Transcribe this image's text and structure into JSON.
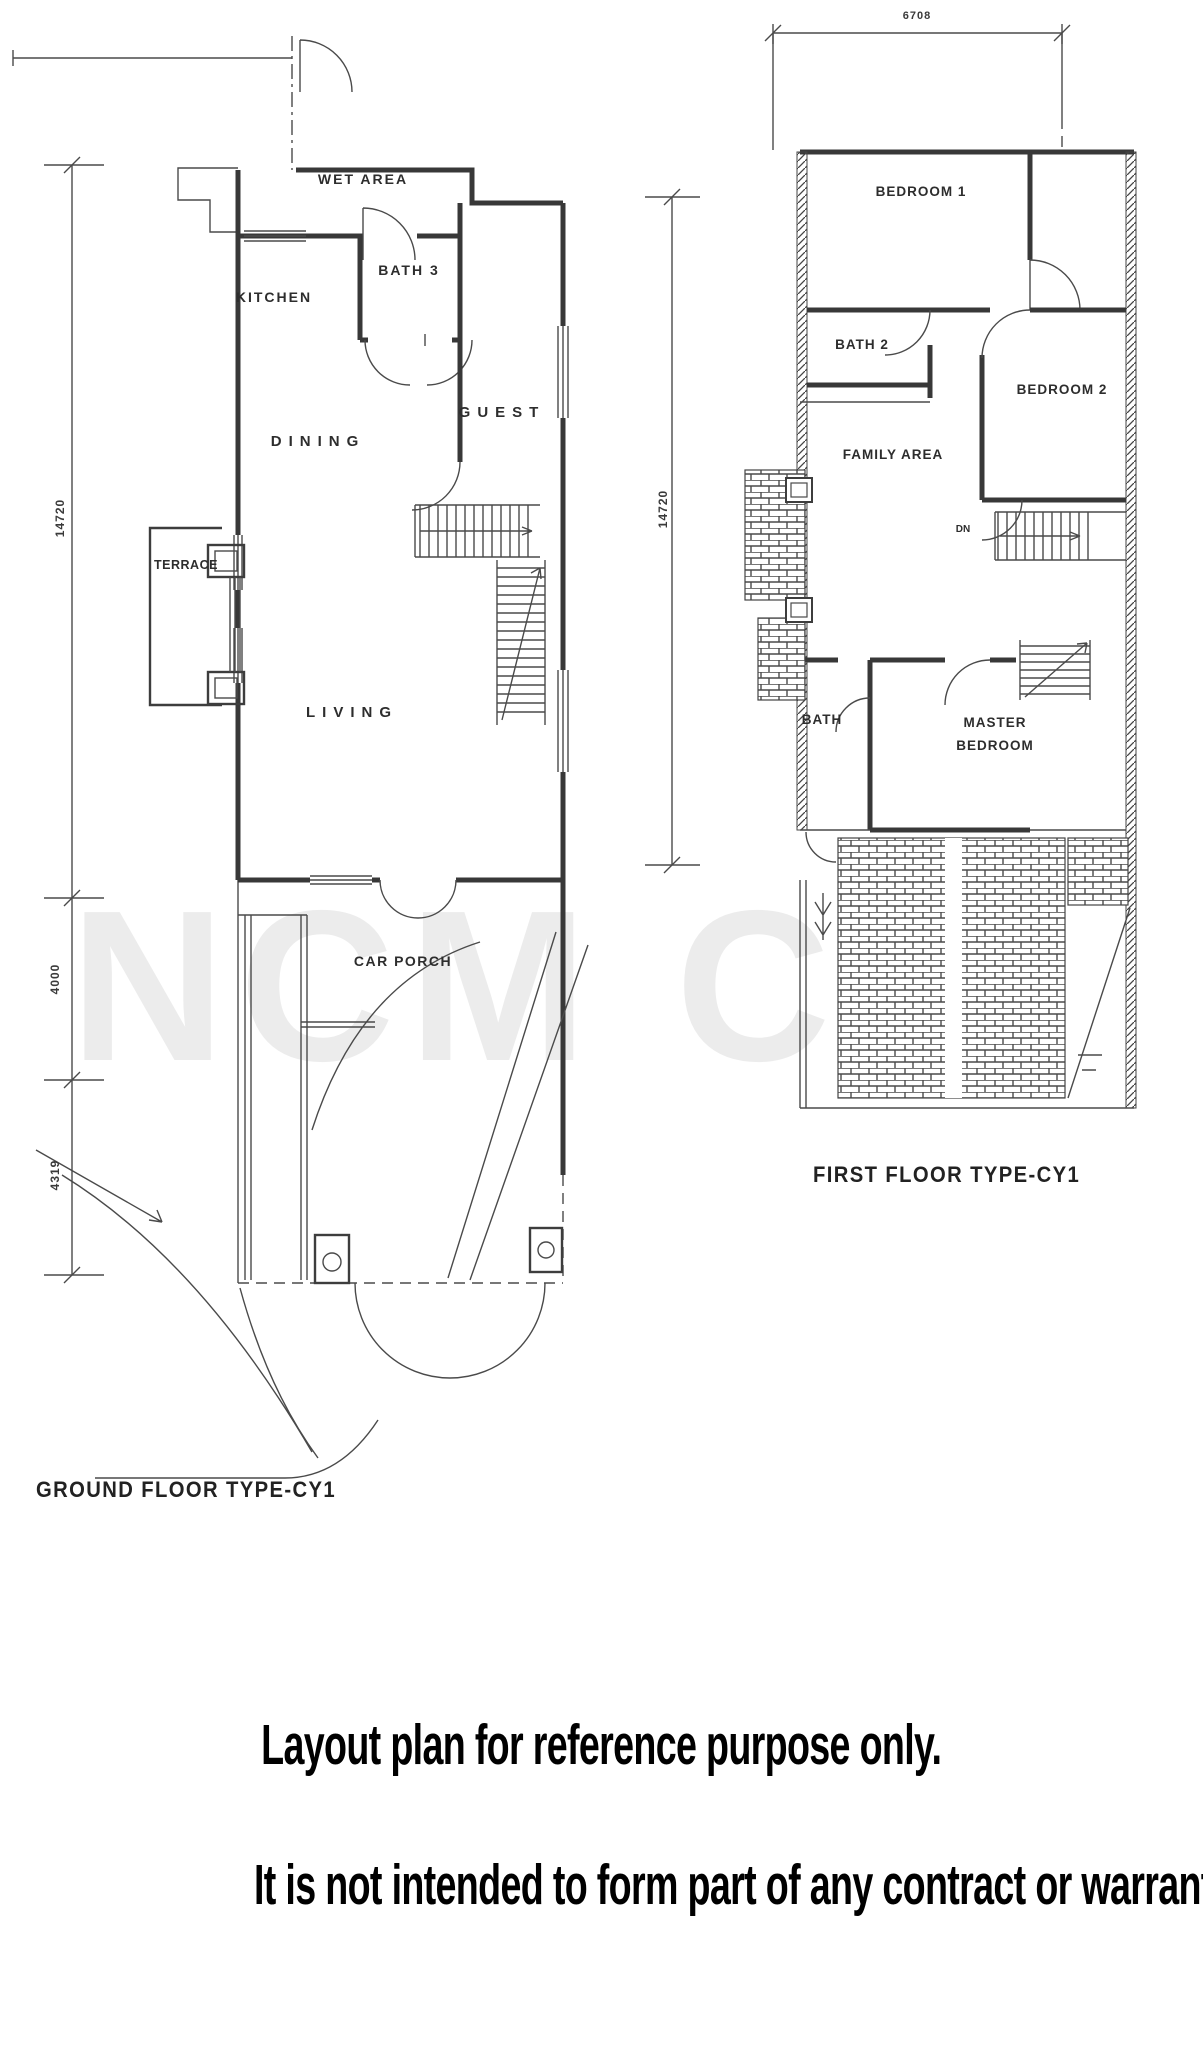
{
  "watermark": "NCM Co",
  "ground_floor": {
    "caption": "GROUND FLOOR TYPE-CY1",
    "rooms": {
      "wet_area": "WET AREA",
      "kitchen": "KITCHEN",
      "bath3": "BATH 3",
      "dining": "DINING",
      "guest": "GUEST",
      "terrace": "TERRACE",
      "living": "LIVING",
      "car_porch": "CAR PORCH"
    },
    "dimensions": {
      "left_upper": "14720",
      "left_middle": "4000",
      "left_lower": "4319"
    }
  },
  "first_floor": {
    "caption": "FIRST FLOOR TYPE-CY1",
    "rooms": {
      "bedroom1": "BEDROOM 1",
      "bath2": "BATH 2",
      "bedroom2": "BEDROOM 2",
      "family_area": "FAMILY AREA",
      "bath": "BATH",
      "master_line1": "MASTER",
      "master_line2": "BEDROOM",
      "down": "DN"
    },
    "dimensions": {
      "top": "6708",
      "left": "14720"
    }
  },
  "disclaimer": {
    "line1": "Layout plan for reference purpose only.",
    "line2": "It is not intended to form part of any contract or warranty."
  },
  "colors": {
    "line": "#3a3a3a",
    "label": "#2d2d2d",
    "background": "#ffffff"
  }
}
